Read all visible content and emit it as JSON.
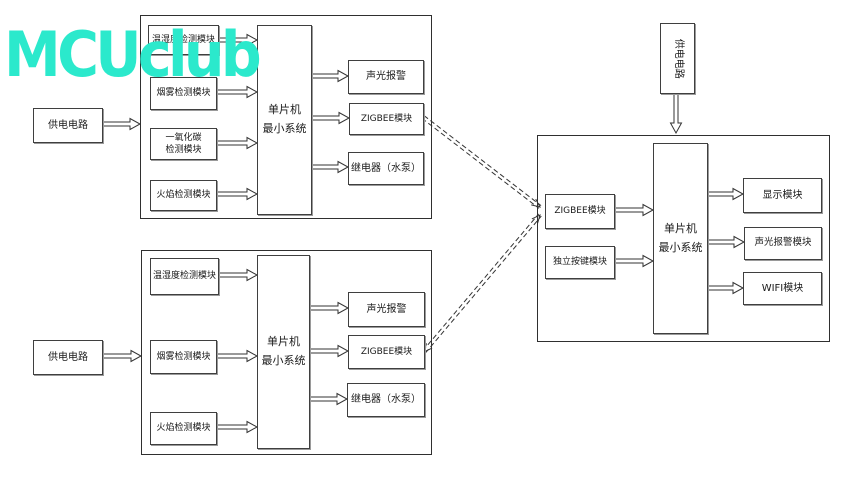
{
  "watermark": {
    "text": "MCUclub",
    "color": "#2BE9CC"
  },
  "system1": {
    "power": "供电电路",
    "sensors": [
      "温湿度检测模块",
      "烟雾检测模块",
      "一氧化碳\n检测模块",
      "火焰检测模块"
    ],
    "mcu": "单片机\n最小系统",
    "outputs": [
      "声光报警",
      "ZIGBEE模块",
      "继电器（水泵）"
    ]
  },
  "system2": {
    "power": "供电电路",
    "sensors": [
      "温湿度检测模块",
      "烟雾检测模块",
      "火焰检测模块"
    ],
    "mcu": "单片机\n最小系统",
    "outputs": [
      "声光报警",
      "ZIGBEE模块",
      "继电器（水泵）"
    ]
  },
  "system3": {
    "power": "供电电路",
    "inputs": [
      "ZIGBEE模块",
      "独立按键模块"
    ],
    "mcu": "单片机\n最小系统",
    "outputs": [
      "显示模块",
      "声光报警模块",
      "WIFI模块"
    ]
  }
}
